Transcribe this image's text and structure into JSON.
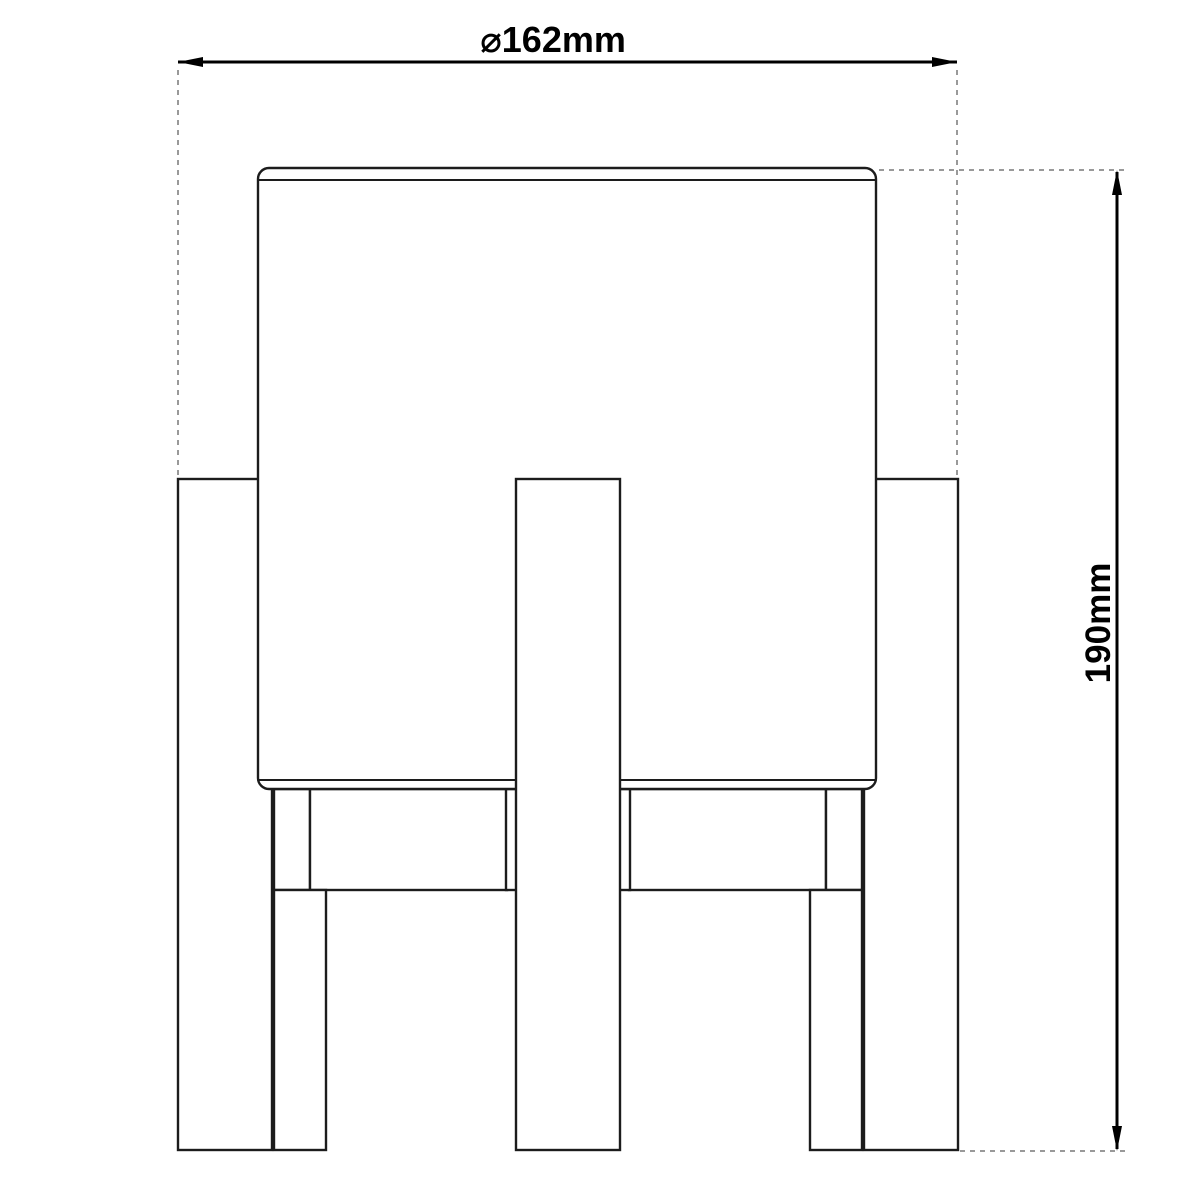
{
  "drawing": {
    "kind": "technical dimension drawing",
    "subject": "table lamp: cylindrical shade on four-leg wooden stand, front elevation",
    "width_dimension": {
      "label": "⌀162mm"
    },
    "height_dimension": {
      "label": "190mm"
    },
    "colors": {
      "background": "#ffffff",
      "outline": "#1c1c1c",
      "dimension": "#000000",
      "extension": "#999999",
      "text": "#000000"
    }
  }
}
